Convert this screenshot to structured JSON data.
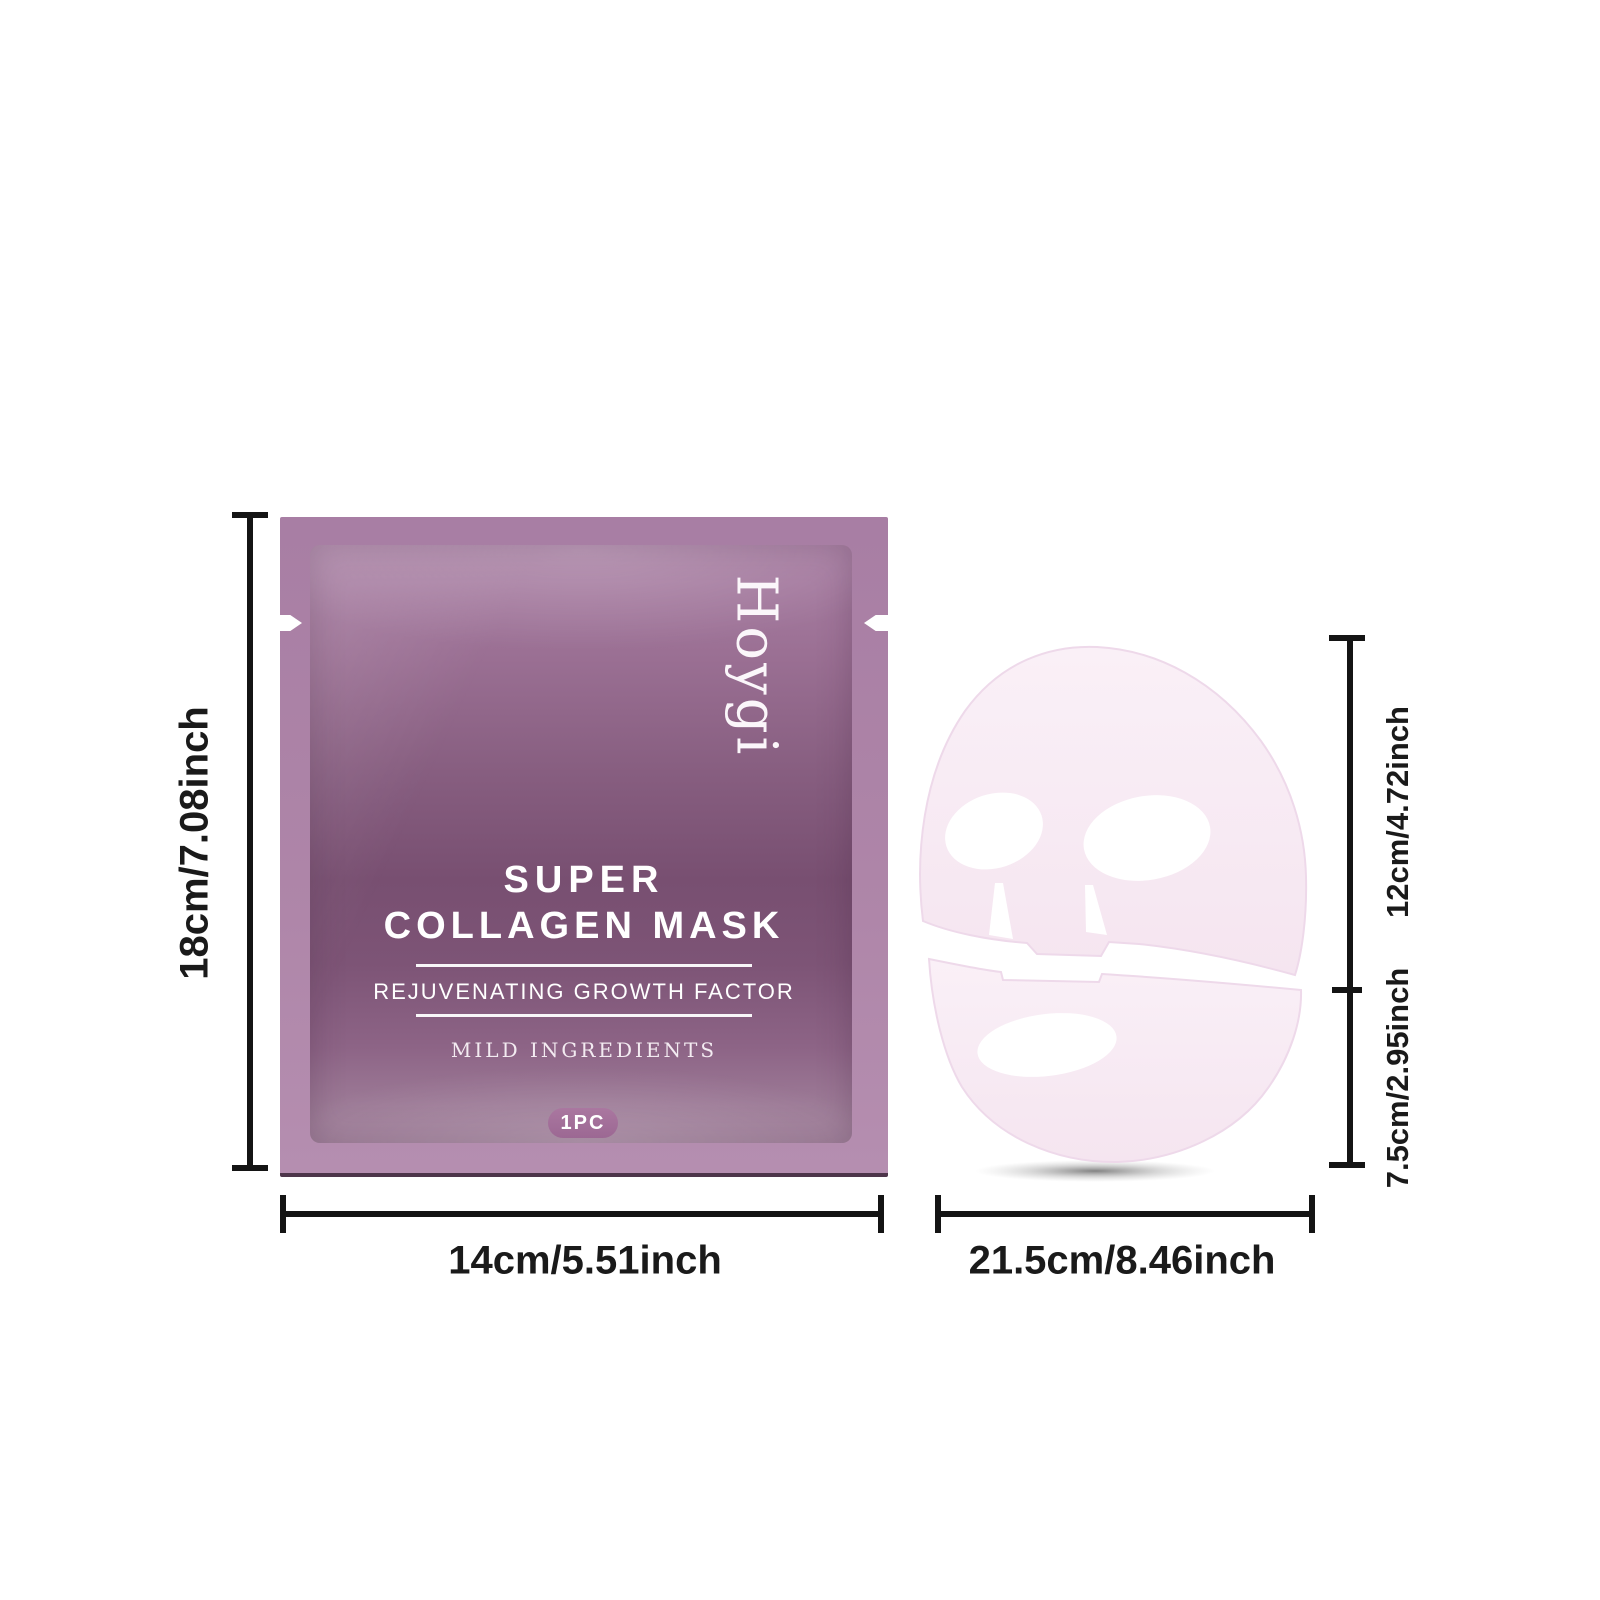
{
  "product": {
    "brand": "Hoygi",
    "title_line1": "SUPER",
    "title_line2": "COLLAGEN MASK",
    "subtitle": "REJUVENATING GROWTH FACTOR",
    "tagline": "MILD INGREDIENTS",
    "quantity": "1PC"
  },
  "annotations": {
    "pouch_height": "18cm/7.08inch",
    "pouch_width": "14cm/5.51inch",
    "mask_face_height": "12cm/4.72inch",
    "mask_chin_height": "7.5cm/2.95inch",
    "mask_width": "21.5cm/8.46inch"
  },
  "colors": {
    "pouch_border": "#ae85a8",
    "pouch_gradient_top": "#aa80a5",
    "pouch_gradient_mid": "#784f71",
    "pouch_gradient_bottom": "#a5859f",
    "badge_fill": "#a06d96",
    "dimension_line": "#141414",
    "mask_fill": "#f8ecf4",
    "text_on_pouch": "#ffffff",
    "background": "#ffffff"
  }
}
